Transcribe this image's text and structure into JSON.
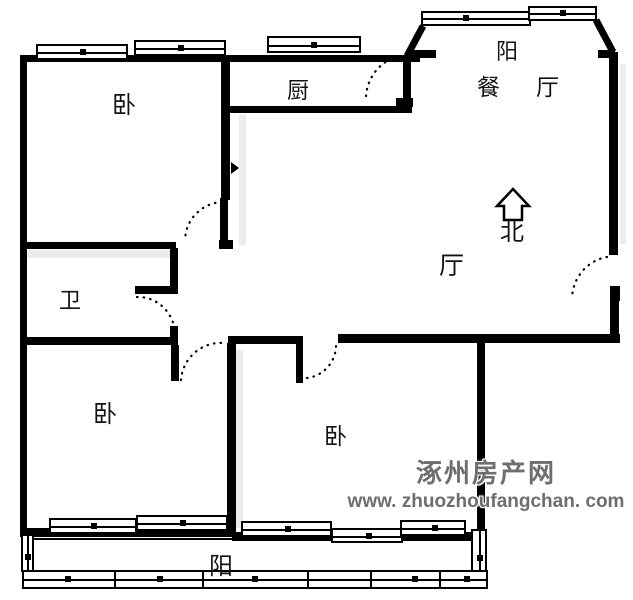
{
  "rooms": {
    "bedroom_top_left": "卧",
    "kitchen": "厨",
    "balcony_top": "阳",
    "dining_room": "餐厅",
    "hall": "厅",
    "bathroom": "卫",
    "bedroom_bottom_left": "卧",
    "bedroom_bottom_middle": "卧",
    "balcony_bottom": "阳"
  },
  "compass": {
    "label": "北",
    "icon": "north-arrow-up"
  },
  "watermark": {
    "site_name": "涿州房产网",
    "site_url": "www. zhuozhoufangchan. com"
  },
  "colors": {
    "wall": "#000000",
    "background": "#ffffff",
    "watermark_text": "#6e6e6e"
  }
}
